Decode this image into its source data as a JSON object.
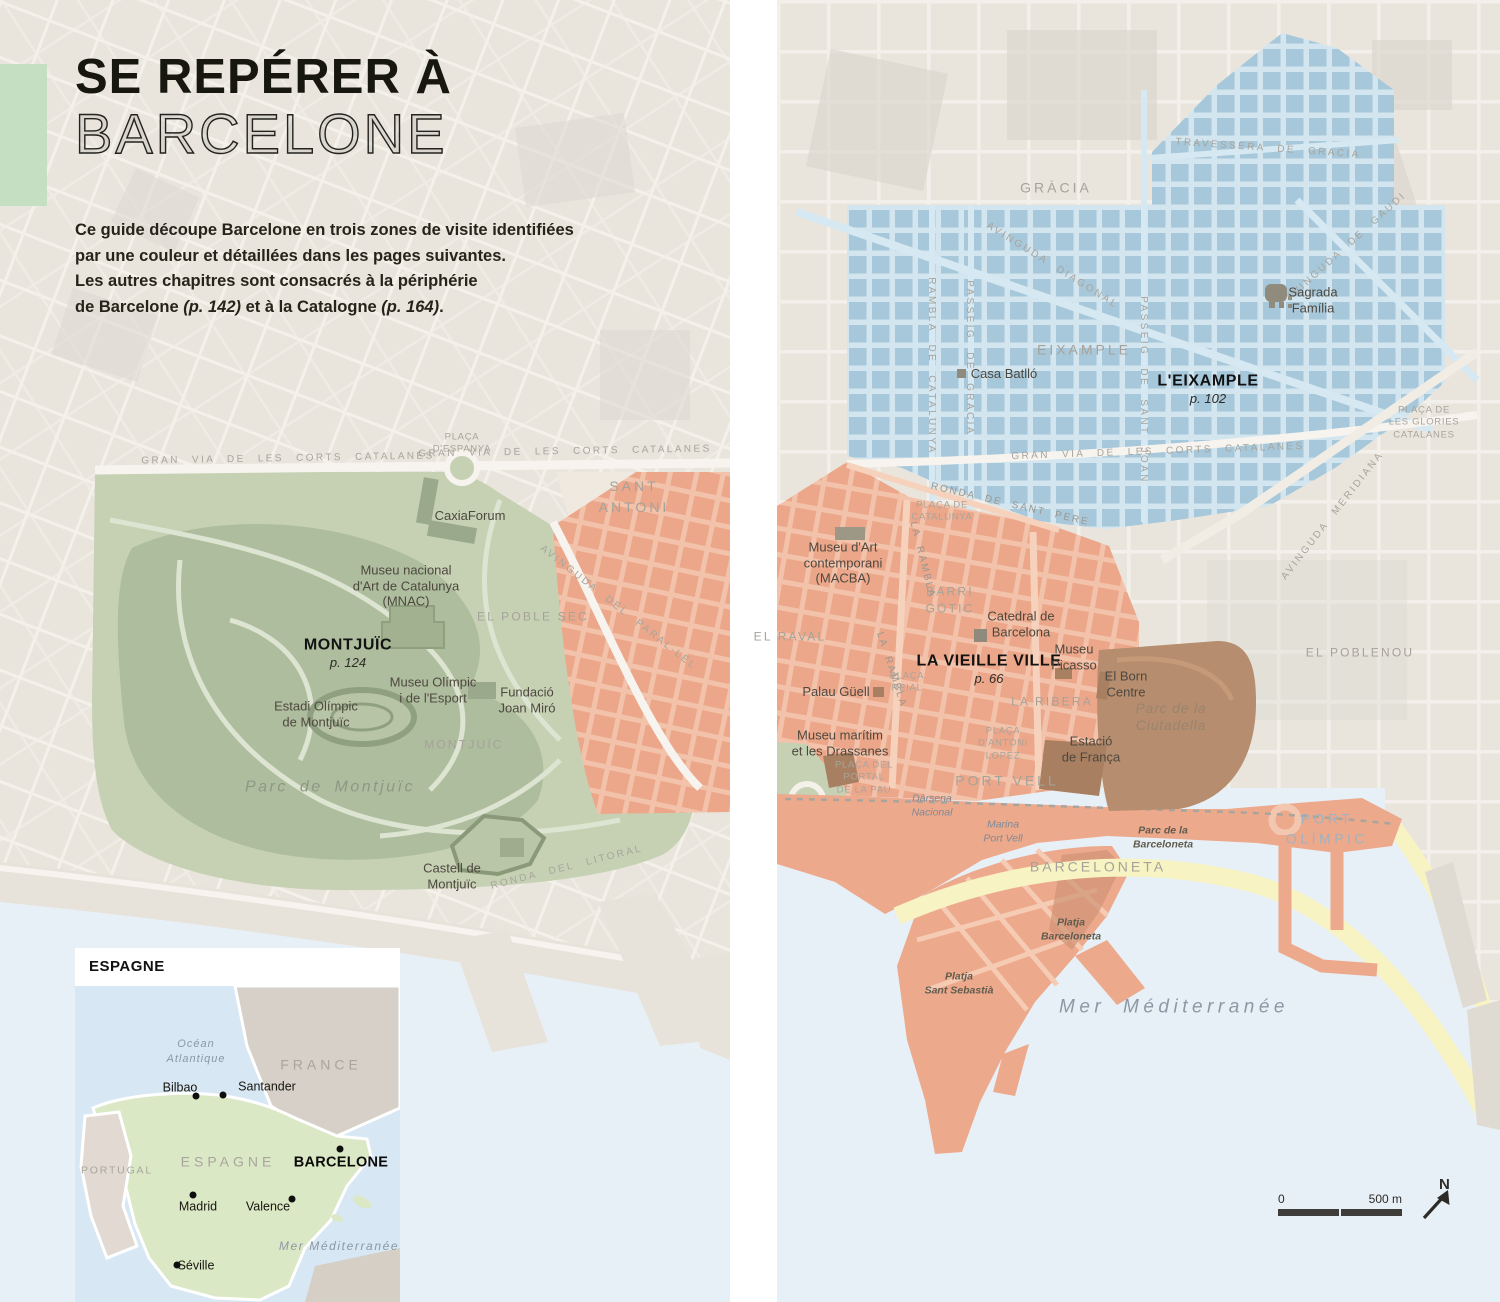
{
  "doc": {
    "title_line1": "SE REPÉRER À",
    "title_line2": "BARCELONE",
    "intro_lines": [
      [
        {
          "t": "Ce guide découpe Barcelone en trois zones de visite identifiées"
        }
      ],
      [
        {
          "t": "par une couleur et détaillées dans les pages suivantes."
        }
      ],
      [
        {
          "t": "Les autres chapitres sont consacrés à la périphérie"
        }
      ],
      [
        {
          "t": "de Barcelone "
        },
        {
          "t": "(p. 142)",
          "i": 1
        },
        {
          "t": " et à la Catalogne "
        },
        {
          "t": "(p. 164)",
          "i": 1
        },
        {
          "t": "."
        }
      ]
    ]
  },
  "zones": [
    {
      "name": "Montjuïc",
      "page": "p. 124",
      "color": "#b3c1a1"
    },
    {
      "name": "La Vieille Ville",
      "page": "p. 66",
      "color": "#eca78a"
    },
    {
      "name": "L'Eixample",
      "page": "p. 102",
      "color": "#a6c8da"
    }
  ],
  "map_labels": [
    {
      "id": "gran-via-left",
      "t": "GRAN VIA DE LES CORTS CATALANES",
      "cls": "street",
      "x": 288,
      "y": 459,
      "rot": -1
    },
    {
      "id": "gran-via-mid",
      "t": "GRAN VIA DE LES CORTS CATALANES",
      "cls": "street",
      "x": 565,
      "y": 452,
      "rot": -1
    },
    {
      "id": "placa-espanya",
      "t": "PLAÇA\nD'ESPANYA",
      "cls": "plaza",
      "x": 462,
      "y": 444
    },
    {
      "id": "sant-antoni",
      "t": "SANT\nANTONI",
      "cls": "area",
      "x": 634,
      "y": 497
    },
    {
      "id": "caixaforum",
      "t": "CaxiaForum",
      "cls": "poi",
      "x": 470,
      "y": 516
    },
    {
      "id": "mnac",
      "t": "Museu nacional\nd'Art de Catalunya\n(MNAC)",
      "cls": "poi",
      "x": 406,
      "y": 586
    },
    {
      "id": "el-poble-sec",
      "t": "EL POBLE SEC",
      "cls": "area-sm",
      "x": 533,
      "y": 617
    },
    {
      "id": "avinguda-paral-lel",
      "t": "AVINGUDA DEL PARAL·LEL",
      "cls": "street",
      "x": 618,
      "y": 608,
      "rot": 38
    },
    {
      "id": "montjuic-title",
      "t": "MONTJUÏC",
      "cls": "zone-title",
      "x": 348,
      "y": 645
    },
    {
      "id": "montjuic-page",
      "t": "p. 124",
      "cls": "zone-page",
      "x": 348,
      "y": 663
    },
    {
      "id": "museu-olimpic",
      "t": "Museu Olímpic\ni de l'Esport",
      "cls": "poi",
      "x": 433,
      "y": 690
    },
    {
      "id": "fundacio-joan-miro",
      "t": "Fundació\nJoan Miró",
      "cls": "poi",
      "x": 527,
      "y": 700
    },
    {
      "id": "estadi-olimpic",
      "t": "Estadi Olímpic\nde Montjuïc",
      "cls": "poi",
      "x": 316,
      "y": 714
    },
    {
      "id": "montjuic-area",
      "t": "MONTJUÏC",
      "cls": "area-sm",
      "x": 464,
      "y": 745
    },
    {
      "id": "parc-de-montjuic",
      "t": "Parc de Montjuïc",
      "cls": "geo-it",
      "x": 330,
      "y": 787
    },
    {
      "id": "castell",
      "t": "Castell de\nMontjuïc",
      "cls": "poi",
      "x": 452,
      "y": 876
    },
    {
      "id": "ronda-litoral",
      "t": "RONDA DEL LITORAL",
      "cls": "street",
      "x": 567,
      "y": 868,
      "rot": -14
    },
    {
      "id": "travessera",
      "t": "TRAVESSERA DE GRACIA",
      "cls": "street",
      "x": 1268,
      "y": 149,
      "rot": 4
    },
    {
      "id": "gracia",
      "t": "GRÀCIA",
      "cls": "area",
      "x": 1056,
      "y": 188
    },
    {
      "id": "avinguda-diagonal",
      "t": "AVINGUDA DIAGONAL",
      "cls": "street",
      "x": 1052,
      "y": 266,
      "rot": 32
    },
    {
      "id": "rambla-catalunya",
      "t": "RAMBLA DE CATALUNYA",
      "cls": "street",
      "x": 931,
      "y": 366,
      "rot": 90
    },
    {
      "id": "passeig-gracia",
      "t": "PASSEIG DE GRACIA",
      "cls": "street",
      "x": 969,
      "y": 358,
      "rot": 90
    },
    {
      "id": "passeig-sant-joan",
      "t": "PASSEIG DE SANT JOAN",
      "cls": "street",
      "x": 1143,
      "y": 390,
      "rot": 90
    },
    {
      "id": "avinguda-gaudi",
      "t": "AVINGUDA DE GAUDI",
      "cls": "street",
      "x": 1347,
      "y": 247,
      "rot": -42
    },
    {
      "id": "sagrada-familia",
      "t": "Sagrada\nFamília",
      "cls": "poi",
      "x": 1313,
      "y": 300
    },
    {
      "id": "eixample-area",
      "t": "EIXAMPLE",
      "cls": "area",
      "x": 1084,
      "y": 350
    },
    {
      "id": "casa-batllo",
      "t": "Casa Batlló",
      "cls": "poi",
      "x": 1004,
      "y": 374
    },
    {
      "id": "eixample-title",
      "t": "L'EIXAMPLE",
      "cls": "zone-title",
      "x": 1208,
      "y": 381
    },
    {
      "id": "eixample-page",
      "t": "p. 102",
      "cls": "zone-page",
      "x": 1208,
      "y": 399
    },
    {
      "id": "placa-glories",
      "t": "PLAÇA DE\nLES GLORIES\nCATALANES",
      "cls": "plaza",
      "x": 1424,
      "y": 423
    },
    {
      "id": "gran-via-right",
      "t": "GRAN VIA DE LES CORTS CATALANES",
      "cls": "street",
      "x": 1158,
      "y": 452,
      "rot": -2
    },
    {
      "id": "avinguda-meridiana",
      "t": "AVINGUDA MERIDIANA",
      "cls": "street",
      "x": 1333,
      "y": 516,
      "rot": -52
    },
    {
      "id": "ronda-sant-pere",
      "t": "RONDA DE SANT PERE",
      "cls": "street-dk",
      "x": 1010,
      "y": 505,
      "rot": 13
    },
    {
      "id": "placa-catalunya",
      "t": "PLAÇA DE\nCATALUNYA",
      "cls": "plaza",
      "x": 942,
      "y": 512
    },
    {
      "id": "el-poblenou",
      "t": "EL POBLENOU",
      "cls": "area-sm",
      "x": 1360,
      "y": 653
    },
    {
      "id": "macba",
      "t": "Museu d'Art\ncontemporani\n(MACBA)",
      "cls": "poi",
      "x": 843,
      "y": 563
    },
    {
      "id": "barri-gotic",
      "t": "BARRI\nGÒTIC",
      "cls": "area-sm",
      "x": 950,
      "y": 601
    },
    {
      "id": "la-rambla-upper",
      "t": "LA RAMBLA",
      "cls": "street-dk",
      "x": 922,
      "y": 560,
      "rot": 76
    },
    {
      "id": "la-rambla-lower",
      "t": "LA RAMBLA",
      "cls": "street-dk",
      "x": 891,
      "y": 670,
      "rot": 72
    },
    {
      "id": "el-raval",
      "t": "EL RAVAL",
      "cls": "area-sm",
      "x": 790,
      "y": 637
    },
    {
      "id": "catedral",
      "t": "Catedral de\nBarcelona",
      "cls": "poi",
      "x": 1021,
      "y": 624
    },
    {
      "id": "vieille-ville-title",
      "t": "LA VIEILLE VILLE",
      "cls": "zone-title",
      "x": 989,
      "y": 661
    },
    {
      "id": "vieille-ville-page",
      "t": "p. 66",
      "cls": "zone-page",
      "x": 989,
      "y": 679
    },
    {
      "id": "museu-picasso",
      "t": "Museu\nPicasso",
      "cls": "poi",
      "x": 1074,
      "y": 657
    },
    {
      "id": "el-born-centre",
      "t": "El Born\nCentre",
      "cls": "poi",
      "x": 1126,
      "y": 684
    },
    {
      "id": "la-ribera",
      "t": "LA RIBERA",
      "cls": "area-sm",
      "x": 1052,
      "y": 702
    },
    {
      "id": "parc-ciutadella",
      "t": "Parc de la\nCiutadella",
      "cls": "geo-brown",
      "x": 1171,
      "y": 717
    },
    {
      "id": "palau-guell",
      "t": "Palau Güell",
      "cls": "poi",
      "x": 836,
      "y": 692
    },
    {
      "id": "placa-reial",
      "t": "PLAÇA\nREIAL",
      "cls": "plaza",
      "x": 907,
      "y": 683
    },
    {
      "id": "museu-maritim",
      "t": "Museu marítim\net les Drassanes",
      "cls": "poi",
      "x": 840,
      "y": 743
    },
    {
      "id": "placa-antoni-lopez",
      "t": "PLAÇA\nD'ANTONI\nLOPEZ",
      "cls": "plaza",
      "x": 1003,
      "y": 744
    },
    {
      "id": "estacio-franca",
      "t": "Estació\nde França",
      "cls": "poi",
      "x": 1091,
      "y": 749
    },
    {
      "id": "placa-portal-pau",
      "t": "PLAÇA DEL\nPORTAL\nDE LA PAU",
      "cls": "plaza",
      "x": 864,
      "y": 778
    },
    {
      "id": "port-vell",
      "t": "PORT VELL",
      "cls": "area",
      "x": 1007,
      "y": 781
    },
    {
      "id": "darsena-nacional",
      "t": "Dàrsena\nNacional",
      "cls": "water-it",
      "x": 932,
      "y": 806
    },
    {
      "id": "marina-port-vell",
      "t": "Marina\nPort Vell",
      "cls": "water-it",
      "x": 1003,
      "y": 832
    },
    {
      "id": "parc-barceloneta",
      "t": "Parc de la\nBarceloneta",
      "cls": "beach-it",
      "x": 1163,
      "y": 838
    },
    {
      "id": "port-olimpic",
      "t": "PORT\nOLÍMPIC",
      "cls": "port-ol",
      "x": 1327,
      "y": 829
    },
    {
      "id": "barceloneta",
      "t": "BARCELONETA",
      "cls": "area",
      "x": 1098,
      "y": 867
    },
    {
      "id": "platja-barceloneta",
      "t": "Platja\nBarceloneta",
      "cls": "beach-it",
      "x": 1071,
      "y": 930
    },
    {
      "id": "platja-sant-sebastia",
      "t": "Platja\nSant Sebastià",
      "cls": "beach-it",
      "x": 959,
      "y": 984
    },
    {
      "id": "mer-mediterranee",
      "t": "Mer Méditerranée",
      "cls": "sea-big",
      "x": 1174,
      "y": 1008
    }
  ],
  "inset": {
    "header": "ESPAGNE",
    "labels": [
      {
        "id": "ocean-atlantique",
        "t": "Océan\nAtlantique",
        "cls": "inset-it",
        "x": 121,
        "y": 66
      },
      {
        "id": "france",
        "t": "FRANCE",
        "cls": "inset-area",
        "x": 246,
        "y": 79
      },
      {
        "id": "portugal",
        "t": "PORTUGAL",
        "cls": "inset-area-sm",
        "x": 42,
        "y": 185
      },
      {
        "id": "espagne",
        "t": "ESPAGNE",
        "cls": "inset-area",
        "x": 153,
        "y": 176
      },
      {
        "id": "mer-mediterranee-inset",
        "t": "Mer Méditerranée",
        "cls": "inset-it-big",
        "x": 264,
        "y": 260
      }
    ],
    "cities": [
      {
        "id": "bilbao",
        "t": "Bilbao",
        "cls": "city",
        "x": 105,
        "y": 102,
        "dx": 121,
        "dy": 110
      },
      {
        "id": "santander",
        "t": "Santander",
        "cls": "city",
        "x": 192,
        "y": 101,
        "dx": 148,
        "dy": 109
      },
      {
        "id": "barcelone",
        "t": "BARCELONE",
        "cls": "city-b",
        "x": 266,
        "y": 177,
        "dx": 265,
        "dy": 163
      },
      {
        "id": "madrid",
        "t": "Madrid",
        "cls": "city",
        "x": 123,
        "y": 221,
        "dx": 118,
        "dy": 209
      },
      {
        "id": "valence",
        "t": "Valence",
        "cls": "city",
        "x": 193,
        "y": 221,
        "dx": 217,
        "dy": 213
      },
      {
        "id": "seville",
        "t": "Séville",
        "cls": "city",
        "x": 121,
        "y": 280,
        "dx": 102,
        "dy": 279
      }
    ]
  },
  "scalebar": {
    "zero": "0",
    "label": "500 m",
    "north": "N"
  }
}
